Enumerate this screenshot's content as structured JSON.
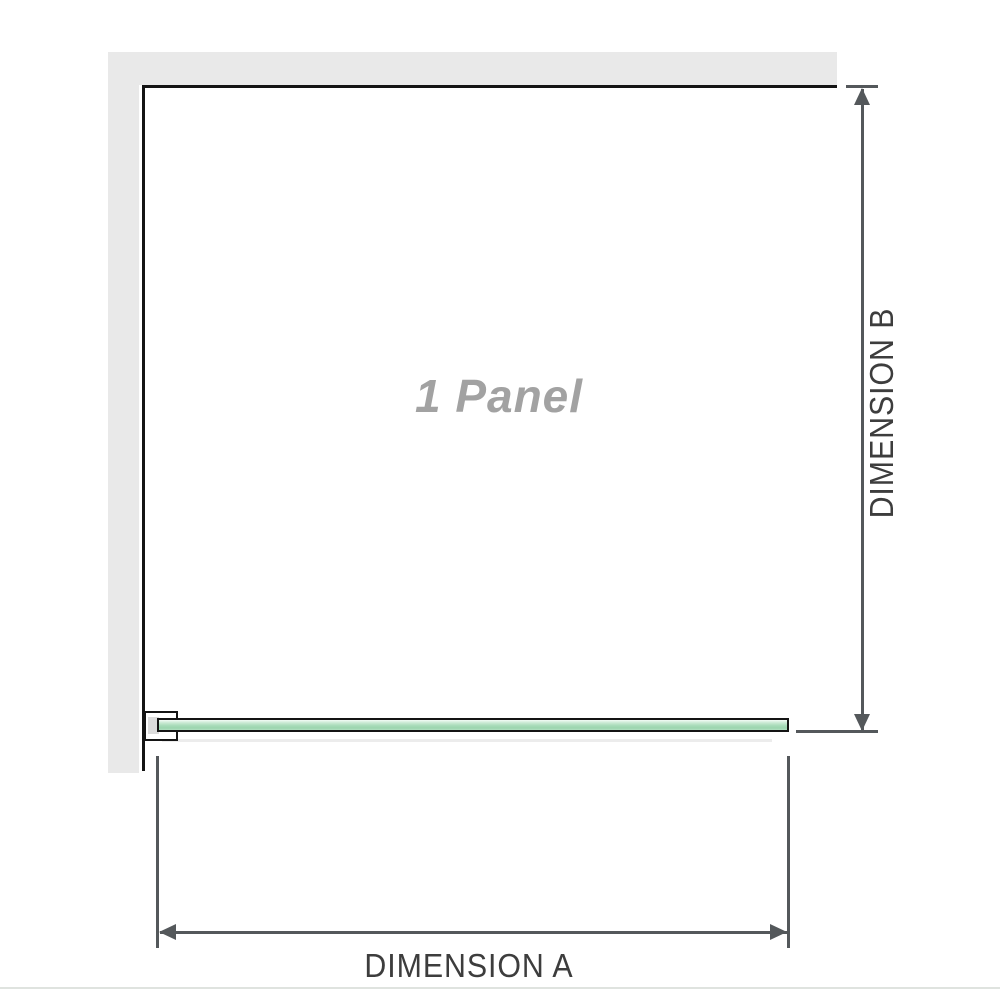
{
  "diagram": {
    "panel_label": "1 Panel",
    "dimensions": {
      "horizontal_label": "DIMENSION A",
      "vertical_label": "DIMENSION B"
    }
  },
  "colors": {
    "background": "#ffffff",
    "wall_fill": "#e9e9e9",
    "structure_line": "#141414",
    "dimension_line": "#54585b",
    "dimension_text": "#3d3d3d",
    "panel_label_text": "#a2a2a2",
    "glass_green": "#a9dcba",
    "bracket_pad": "#dcdcdc",
    "footer_rule": "#dfe3df"
  }
}
